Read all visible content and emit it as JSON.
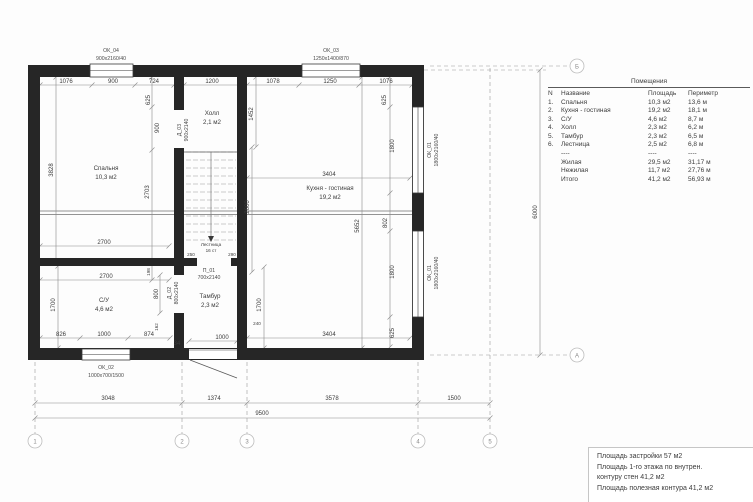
{
  "plan": {
    "windows": {
      "ok04": {
        "id": "ОК_04",
        "size": "900х2160/40"
      },
      "ok03": {
        "id": "ОК_03",
        "size": "1250х1400/870"
      },
      "ok02": {
        "id": "ОК_02",
        "size": "1000х700/1500"
      },
      "ok01": {
        "id": "ОК_01",
        "size": "1800х2160/40"
      }
    },
    "doors": {
      "d03": {
        "id": "Д_03",
        "size": "900х2140"
      },
      "d02": {
        "id": "Д_02",
        "size": "800х2140"
      },
      "p01": {
        "id": "П_01",
        "size": "700х2140"
      }
    },
    "stairs": {
      "label": "Лестница",
      "note": "16 ст"
    },
    "rooms": {
      "bedroom": {
        "name": "Спальня",
        "area": "10,3 м2"
      },
      "hall": {
        "name": "Холл",
        "area": "2,1 м2"
      },
      "kitchen": {
        "name": "Кухня - гостиная",
        "area": "19,2 м2"
      },
      "wc": {
        "name": "С/У",
        "area": "4,6 м2"
      },
      "tambour": {
        "name": "Тамбур",
        "area": "2,3 м2"
      }
    },
    "dims": {
      "top": [
        "1076",
        "900",
        "724",
        "1200",
        "1078",
        "1250",
        "1076"
      ],
      "inner_h": [
        "2700",
        "2700",
        "3404",
        "3404",
        "826",
        "1000",
        "874",
        "34",
        "1000",
        "250",
        "290",
        "240"
      ],
      "inner_v": [
        "3828",
        "625",
        "900",
        "2703",
        "198",
        "800",
        "162",
        "1700",
        "1452",
        "2600",
        "5652",
        "802",
        "1800",
        "1800",
        "625",
        "625",
        "1700"
      ],
      "site": [
        "3048",
        "1374",
        "3578",
        "1500"
      ],
      "site_total": "9500",
      "height_total": "6000"
    }
  },
  "axes": {
    "cols": [
      "1",
      "2",
      "3",
      "4",
      "5"
    ],
    "row_top": "Б",
    "row_bottom": "А"
  },
  "table": {
    "title": "Помещения",
    "headers": {
      "n": "N",
      "name": "Название",
      "area": "Площадь",
      "perim": "Периметр"
    },
    "rows": [
      {
        "n": "1.",
        "name": "Спальня",
        "area": "10,3 м2",
        "perim": "13,6 м"
      },
      {
        "n": "2.",
        "name": "Кухня - гостиная",
        "area": "19,2 м2",
        "perim": "18,1 м"
      },
      {
        "n": "3.",
        "name": "С/У",
        "area": "4,6 м2",
        "perim": "8,7 м"
      },
      {
        "n": "4.",
        "name": "Холл",
        "area": "2,3 м2",
        "perim": "6,2 м"
      },
      {
        "n": "5.",
        "name": "Тамбур",
        "area": "2,3 м2",
        "perim": "6,5 м"
      },
      {
        "n": "6.",
        "name": "Лестница",
        "area": "2,5 м2",
        "perim": "6,8 м"
      }
    ],
    "dash": "----",
    "summary": [
      {
        "name": "Жилая",
        "area": "29,5 м2",
        "perim": "31,17 м"
      },
      {
        "name": "Нежилая",
        "area": "11,7 м2",
        "perim": "27,76 м"
      },
      {
        "name": "Итого",
        "area": "41,2 м2",
        "perim": "56,93 м"
      }
    ]
  },
  "info_box": {
    "lines": [
      "Площадь застройки  57 м2",
      "Площадь 1-го этажа по внутрен.",
      "контуру стен  41,2 м2",
      "Площадь полезная контура  41,2 м2"
    ]
  }
}
